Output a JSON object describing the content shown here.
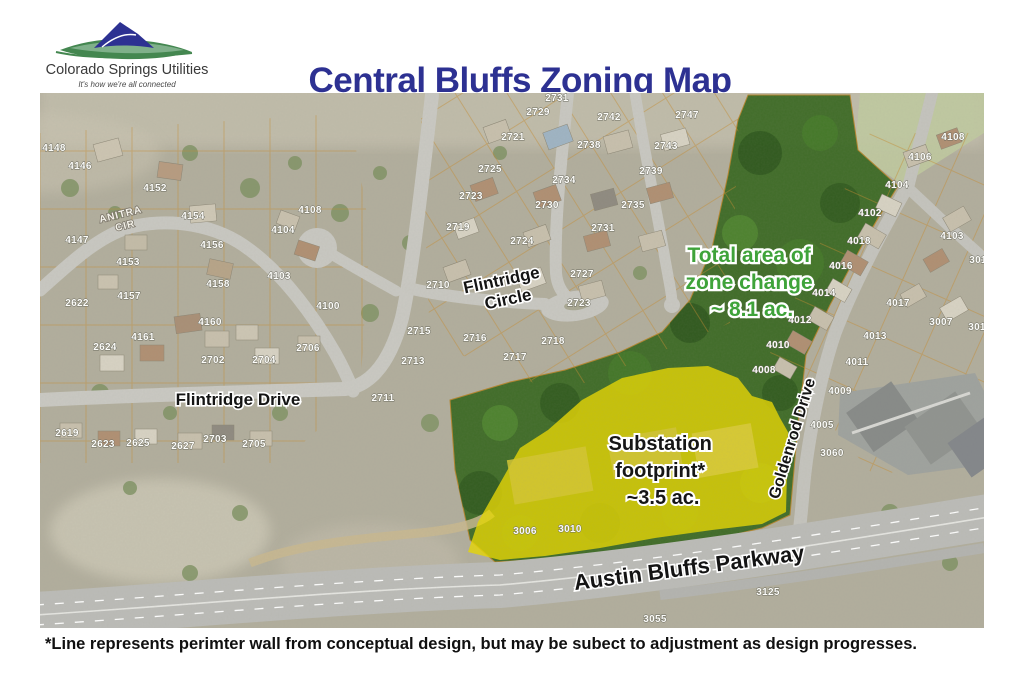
{
  "header": {
    "logo_name": "Colorado Springs Utilities",
    "logo_tagline": "It's how we're all connected",
    "title": "Central Bluffs Zoning Map",
    "title_color": "#2d3192"
  },
  "map": {
    "annotations": {
      "zone_change": {
        "lines": [
          "Total area of",
          "zone change",
          "~ 8.1 ac."
        ],
        "color": "#3fa33a"
      },
      "substation": {
        "lines": [
          "Substation",
          "footprint*",
          "~3.5 ac."
        ],
        "color": "#161616"
      }
    },
    "streets": {
      "anitra": [
        "ANITRA",
        "CIR"
      ],
      "flintridge_circle": [
        "Flintridge",
        "Circle"
      ],
      "flintridge_drive": "Flintridge Drive",
      "goldenrod": "Goldenrod Drive",
      "austin_bluffs": "Austin Bluffs Parkway"
    },
    "zone_colors": {
      "zone_change_fill": "#3c6a24",
      "substation_fill": "#e8d800",
      "parcel_line": "#c58a2e"
    },
    "parcels": [
      {
        "n": "4148",
        "x": 14,
        "y": 58
      },
      {
        "n": "4146",
        "x": 40,
        "y": 76
      },
      {
        "n": "4152",
        "x": 115,
        "y": 98
      },
      {
        "n": "4154",
        "x": 153,
        "y": 126
      },
      {
        "n": "4147",
        "x": 37,
        "y": 150
      },
      {
        "n": "4156",
        "x": 172,
        "y": 155
      },
      {
        "n": "4153",
        "x": 88,
        "y": 172
      },
      {
        "n": "4158",
        "x": 178,
        "y": 194
      },
      {
        "n": "4157",
        "x": 89,
        "y": 206
      },
      {
        "n": "2622",
        "x": 37,
        "y": 213
      },
      {
        "n": "2624",
        "x": 65,
        "y": 257
      },
      {
        "n": "4161",
        "x": 103,
        "y": 247
      },
      {
        "n": "4160",
        "x": 170,
        "y": 232
      },
      {
        "n": "2702",
        "x": 173,
        "y": 270
      },
      {
        "n": "2704",
        "x": 224,
        "y": 270
      },
      {
        "n": "2706",
        "x": 268,
        "y": 258
      },
      {
        "n": "2619",
        "x": 27,
        "y": 343
      },
      {
        "n": "2623",
        "x": 63,
        "y": 354
      },
      {
        "n": "2625",
        "x": 98,
        "y": 353
      },
      {
        "n": "2627",
        "x": 143,
        "y": 356
      },
      {
        "n": "2703",
        "x": 175,
        "y": 349
      },
      {
        "n": "2705",
        "x": 214,
        "y": 354
      },
      {
        "n": "4108",
        "x": 270,
        "y": 120
      },
      {
        "n": "4104",
        "x": 243,
        "y": 140
      },
      {
        "n": "4103",
        "x": 239,
        "y": 186
      },
      {
        "n": "4100",
        "x": 288,
        "y": 216
      },
      {
        "n": "2731",
        "x": 517,
        "y": 8
      },
      {
        "n": "2729",
        "x": 498,
        "y": 22
      },
      {
        "n": "2742",
        "x": 569,
        "y": 27
      },
      {
        "n": "2747",
        "x": 647,
        "y": 25
      },
      {
        "n": "2721",
        "x": 473,
        "y": 47
      },
      {
        "n": "2738",
        "x": 549,
        "y": 55
      },
      {
        "n": "2743",
        "x": 626,
        "y": 56
      },
      {
        "n": "2725",
        "x": 450,
        "y": 79
      },
      {
        "n": "2734",
        "x": 524,
        "y": 90
      },
      {
        "n": "2739",
        "x": 611,
        "y": 81
      },
      {
        "n": "2723",
        "x": 431,
        "y": 106
      },
      {
        "n": "2730",
        "x": 507,
        "y": 115
      },
      {
        "n": "2735",
        "x": 593,
        "y": 115
      },
      {
        "n": "2719",
        "x": 418,
        "y": 137
      },
      {
        "n": "2724",
        "x": 482,
        "y": 151
      },
      {
        "n": "2731",
        "x": 563,
        "y": 138
      },
      {
        "n": "2727",
        "x": 542,
        "y": 184
      },
      {
        "n": "2710",
        "x": 398,
        "y": 195
      },
      {
        "n": "2723",
        "x": 539,
        "y": 213
      },
      {
        "n": "2715",
        "x": 379,
        "y": 241
      },
      {
        "n": "2716",
        "x": 435,
        "y": 248
      },
      {
        "n": "2717",
        "x": 475,
        "y": 267
      },
      {
        "n": "2718",
        "x": 513,
        "y": 251
      },
      {
        "n": "2713",
        "x": 373,
        "y": 271
      },
      {
        "n": "2711",
        "x": 343,
        "y": 308
      },
      {
        "n": "4108",
        "x": 913,
        "y": 47
      },
      {
        "n": "4106",
        "x": 880,
        "y": 67
      },
      {
        "n": "4104",
        "x": 857,
        "y": 95
      },
      {
        "n": "4102",
        "x": 830,
        "y": 123
      },
      {
        "n": "4103",
        "x": 912,
        "y": 146
      },
      {
        "n": "301",
        "x": 938,
        "y": 170
      },
      {
        "n": "4018",
        "x": 819,
        "y": 151
      },
      {
        "n": "4016",
        "x": 801,
        "y": 176
      },
      {
        "n": "4014",
        "x": 784,
        "y": 203
      },
      {
        "n": "4017",
        "x": 858,
        "y": 213
      },
      {
        "n": "4012",
        "x": 760,
        "y": 230
      },
      {
        "n": "4013",
        "x": 835,
        "y": 246
      },
      {
        "n": "4010",
        "x": 738,
        "y": 255
      },
      {
        "n": "3007",
        "x": 901,
        "y": 232
      },
      {
        "n": "301",
        "x": 937,
        "y": 237
      },
      {
        "n": "4008",
        "x": 724,
        "y": 280
      },
      {
        "n": "4011",
        "x": 817,
        "y": 272
      },
      {
        "n": "4009",
        "x": 800,
        "y": 301
      },
      {
        "n": "4005",
        "x": 782,
        "y": 335
      },
      {
        "n": "3060",
        "x": 792,
        "y": 363
      },
      {
        "n": "3006",
        "x": 485,
        "y": 441
      },
      {
        "n": "3010",
        "x": 530,
        "y": 439
      },
      {
        "n": "3125",
        "x": 728,
        "y": 502
      },
      {
        "n": "3055",
        "x": 615,
        "y": 529
      }
    ]
  },
  "footer": {
    "note": "*Line represents perimter wall from conceptual design, but may be subect to adjustment as design progresses."
  }
}
